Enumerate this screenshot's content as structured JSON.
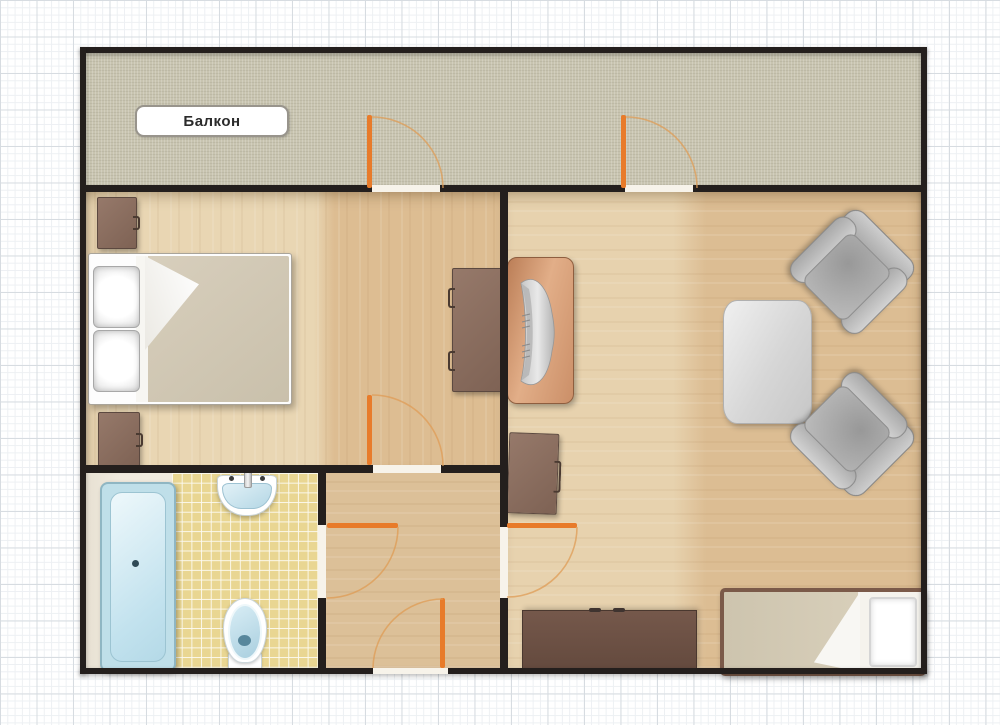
{
  "labels": {
    "balcony": "Балкон"
  },
  "palette": {
    "wall": "#241f1d",
    "door_leaf": "#e87b2a",
    "door_swing_arc": "#df9c55",
    "balcony_floor": "#c8c4b0",
    "wood_floor_light": "#e9d6b3",
    "wood_floor_dark": "#ddbd92",
    "bathroom_tile": "#e9d692",
    "fixture_blue": "#bfdfe9",
    "furniture_brown": "#8b6f60",
    "sideboard_brown": "#6b5044",
    "armchair_gray": "#b5b5b5",
    "mattress_beige": "#d3cab6",
    "grid_paper_line": "#d7dce1"
  },
  "rooms": [
    {
      "id": "balcony",
      "label": "Балкон",
      "furniture": []
    },
    {
      "id": "bedroom",
      "furniture": [
        "double-bed",
        "nightstand-top",
        "nightstand-bottom",
        "desk"
      ]
    },
    {
      "id": "living-room",
      "furniture": [
        "piano",
        "bedside-cabinet",
        "coffee-table",
        "armchair-upper",
        "armchair-lower",
        "single-bed",
        "sideboard"
      ]
    },
    {
      "id": "bathroom",
      "furniture": [
        "bathtub",
        "wash-basin",
        "toilet"
      ]
    },
    {
      "id": "entry-hall",
      "furniture": []
    }
  ],
  "doors": [
    {
      "id": "balcony-door-left",
      "state": "open"
    },
    {
      "id": "balcony-door-right",
      "state": "open"
    },
    {
      "id": "bedroom-hall-door",
      "state": "open"
    },
    {
      "id": "bathroom-door",
      "state": "open"
    },
    {
      "id": "living-room-door",
      "state": "open"
    },
    {
      "id": "entry-door",
      "state": "open"
    }
  ]
}
